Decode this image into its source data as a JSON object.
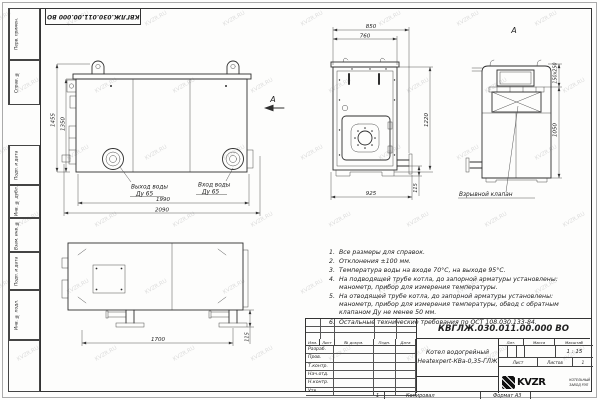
{
  "watermark": {
    "text": "KVZR.RU"
  },
  "frame": {
    "top_doc_number": "КВГЛЖ.030.011.00.000 ВО",
    "sidebar_labels": [
      "Перв. примен.",
      "Справ. №",
      "Подп. и дата",
      "Инв. № дубл.",
      "Взам. инв. №",
      "Подп. и дата",
      "Инв. № подл."
    ],
    "footer": {
      "copy_number": "1",
      "copied": "Копировал",
      "format": "Формат А3"
    }
  },
  "views": {
    "front": {
      "dim_outer_width": "2090",
      "dim_inner_width": "1990",
      "dim_outer_height": "1455",
      "dim_inner_height": "1350",
      "outlet_label": "Выход воды",
      "outlet_dn": "Ду 65",
      "inlet_label": "Вход воды",
      "inlet_dn": "Ду 65",
      "view_arrow_label": "А"
    },
    "side": {
      "dim_top_outer": "850",
      "dim_top_inner": "760",
      "dim_width": "925",
      "dim_height": "1220",
      "dim_pipe_offset": "115"
    },
    "rear": {
      "view_label": "А",
      "dim_valve": "150х250",
      "dim_height": "1050",
      "valve_label": "Взрывной клапан"
    },
    "bottom": {
      "dim_length": "1700",
      "dim_leg_height": "115"
    }
  },
  "notes": {
    "items": [
      "Все размеры для справок.",
      "Отклонения ±100 мм.",
      "Температура воды на входе 70°С, на выходе 95°С.",
      "На подводящей трубе котла, до запорной арматуры установлены: манометр, прибор для измерения температуры.",
      "На отводящей трубе котла, до запорной арматуры установлены: манометр, прибор для измерения температуры, обвод с обратным клапаном Ду не менее 50 мм.",
      "Остальные технические требования по ОСТ 108.030.133-84."
    ]
  },
  "title_block": {
    "doc_number": "КВГЛЖ.030.011.00.000 ВО",
    "name_line1": "Котел водогрейный",
    "name_line2": "Heatexpert-КВа-0,35-ГЛЖ",
    "columns": [
      "Изм.",
      "Лист",
      "№ докум.",
      "Подп.",
      "Дата"
    ],
    "rows": [
      "Разраб.",
      "Пров.",
      "Т.контр.",
      "Нач.отд.",
      "Н.контр.",
      "Утв."
    ],
    "lit_label": "Лит.",
    "mass_label": "Масса",
    "scale_label": "Масштаб",
    "scale_value": "1 : 15",
    "sheet_label": "Лист",
    "sheets_label": "Листов",
    "sheets_value": "1",
    "logo_text": "KVZR",
    "org_line1": "КОТЕЛЬНЫЙ",
    "org_line2": "ЗАВОД РЭП"
  }
}
